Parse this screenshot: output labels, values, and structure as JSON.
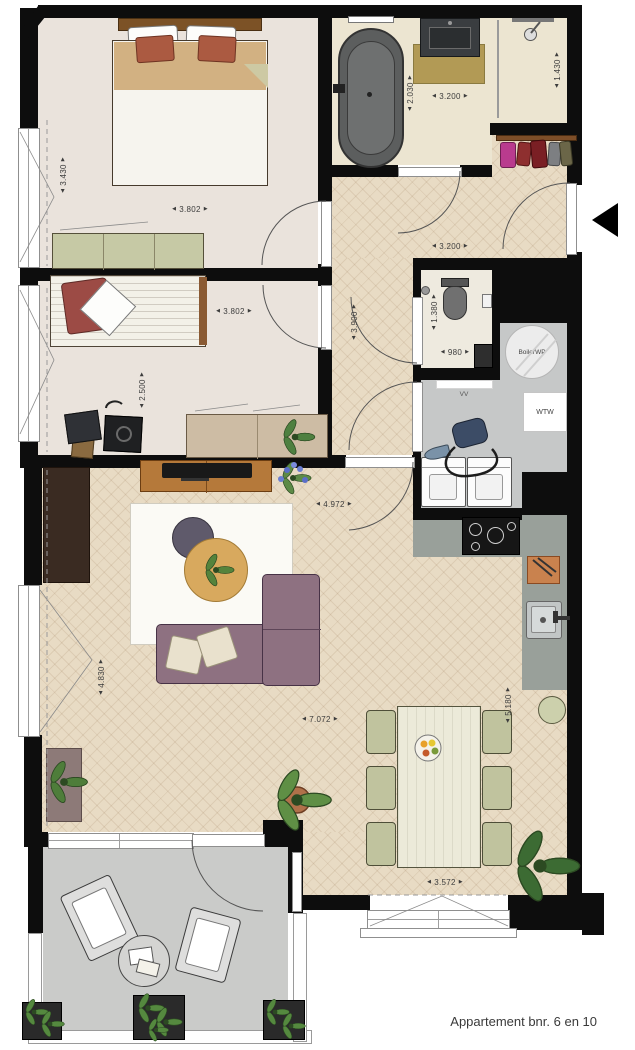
{
  "footer": {
    "label": "Appartement bnr. 6 en 10"
  },
  "dims": [
    {
      "id": "bedroom1-width",
      "value": "3.430",
      "orient": "v"
    },
    {
      "id": "bedroom1-length",
      "value": "3.802",
      "orient": "h"
    },
    {
      "id": "bathroom-depth",
      "value": "2.030",
      "orient": "v"
    },
    {
      "id": "bathroom-width",
      "value": "3.200",
      "orient": "h"
    },
    {
      "id": "shower-width",
      "value": "1.430",
      "orient": "v"
    },
    {
      "id": "entry-hall-width",
      "value": "3.200",
      "orient": "h"
    },
    {
      "id": "bedroom2-length",
      "value": "3.802",
      "orient": "h"
    },
    {
      "id": "hallway-length",
      "value": "3.900",
      "orient": "v"
    },
    {
      "id": "toilet-depth",
      "value": "1.380",
      "orient": "v"
    },
    {
      "id": "toilet-width",
      "value": "980",
      "orient": "h"
    },
    {
      "id": "bedroom2-depth",
      "value": "2.500",
      "orient": "v"
    },
    {
      "id": "living-width-upper",
      "value": "4.972",
      "orient": "h"
    },
    {
      "id": "living-depth",
      "value": "4.830",
      "orient": "v"
    },
    {
      "id": "living-width",
      "value": "7.072",
      "orient": "h"
    },
    {
      "id": "kitchen-depth",
      "value": "5.180",
      "orient": "v"
    },
    {
      "id": "dining-width",
      "value": "3.572",
      "orient": "h"
    }
  ],
  "utility": {
    "boiler_label": "BoilerWP",
    "wtw_label": "WTW",
    "vv_label": "VV"
  },
  "colors": {
    "wall": "#0d0d0d",
    "wood_floor": "#e8dbc4",
    "sofa": "#8e7181",
    "counter": "#99a09a",
    "accent_plant": "#4e7d3a"
  }
}
